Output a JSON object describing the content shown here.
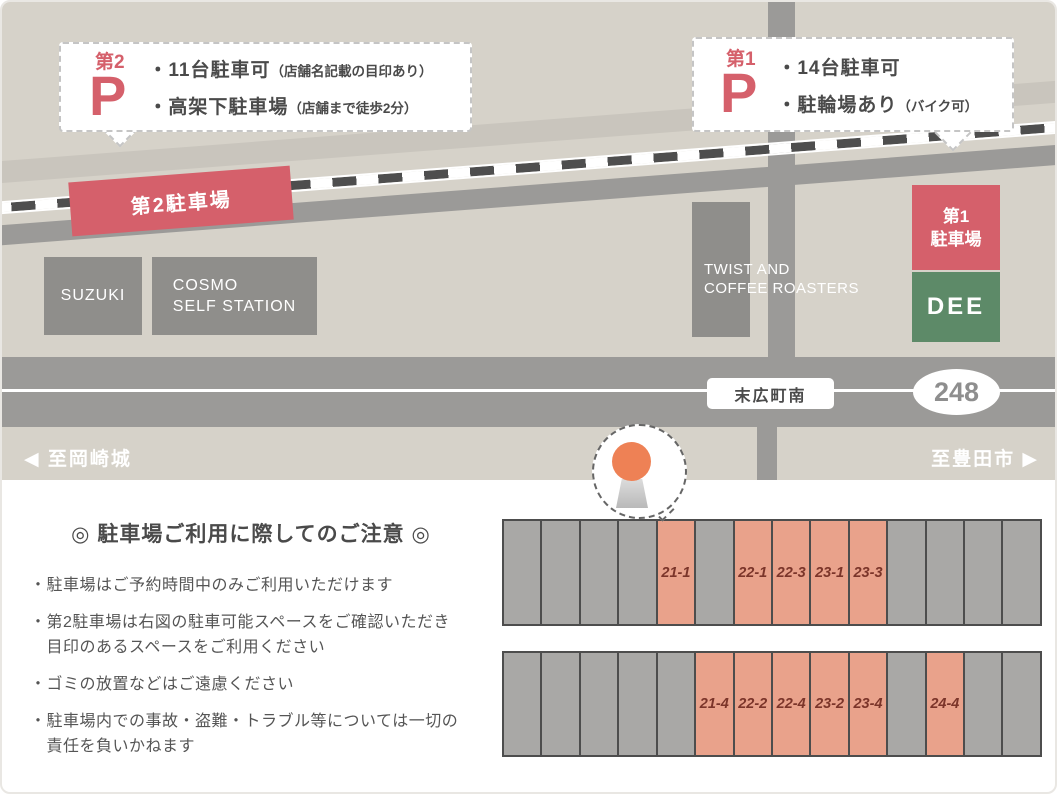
{
  "map": {
    "callout_p2": {
      "badge": "第2",
      "p_letter": "P",
      "lines": [
        {
          "main": "・11台駐車可",
          "note": "（店舗名記載の目印あり）"
        },
        {
          "main": "・高架下駐車場",
          "note": "（店舗まで徒歩2分）"
        }
      ]
    },
    "callout_p1": {
      "badge": "第1",
      "p_letter": "P",
      "lines": [
        {
          "main": "・14台駐車可",
          "note": ""
        },
        {
          "main": "・駐輪場あり",
          "note": "（バイク可）"
        }
      ]
    },
    "labels": {
      "p2_lot": "第2駐車場",
      "p1_lot": "第1\n駐車場",
      "dee": "DEE",
      "suzuki": "SUZUKI",
      "cosmo": "COSMO\nSELF STATION",
      "twist": "TWIST AND\nCOFFEE ROASTERS",
      "intersection": "末広町南",
      "route_number": "248",
      "dir_left": "◀ 至岡崎城",
      "dir_right": "至豊田市 ▶"
    }
  },
  "notice": {
    "title": "◎ 駐車場ご利用に際してのご注意 ◎",
    "items": [
      "・駐車場はご予約時間中のみご利用いただけます",
      "・第2駐車場は右図の駐車可能スペースをご確認いただき\n　目印のあるスペースをご利用ください",
      "・ゴミの放置などはご遠慮ください",
      "・駐車場内での事故・盗難・トラブル等については一切の\n　責任を負いかねます"
    ]
  },
  "parking": {
    "rows": [
      {
        "cells": [
          {},
          {},
          {},
          {},
          {
            "highlight": true,
            "label": "21-1"
          },
          {},
          {
            "highlight": true,
            "label": "22-1"
          },
          {
            "highlight": true,
            "label": "22-3"
          },
          {
            "highlight": true,
            "label": "23-1"
          },
          {
            "highlight": true,
            "label": "23-3"
          },
          {},
          {},
          {},
          {}
        ]
      },
      {
        "cells": [
          {},
          {},
          {},
          {},
          {},
          {
            "highlight": true,
            "label": "21-4"
          },
          {
            "highlight": true,
            "label": "22-2"
          },
          {
            "highlight": true,
            "label": "22-4"
          },
          {
            "highlight": true,
            "label": "23-2"
          },
          {
            "highlight": true,
            "label": "23-4"
          },
          {},
          {
            "highlight": true,
            "label": "24-4"
          },
          {},
          {}
        ]
      }
    ]
  },
  "colors": {
    "map_background": "#d6d2c9",
    "road_gray": "#9b9a98",
    "road_light": "#c9c5bd",
    "building_gray": "#8f8e8b",
    "lot_red": "#d5606b",
    "dee_green": "#5d8a68",
    "space_gray": "#a9a8a6",
    "space_highlight": "#e9a28b",
    "space_label": "#7b352a",
    "marker_orange": "#ee8155"
  }
}
